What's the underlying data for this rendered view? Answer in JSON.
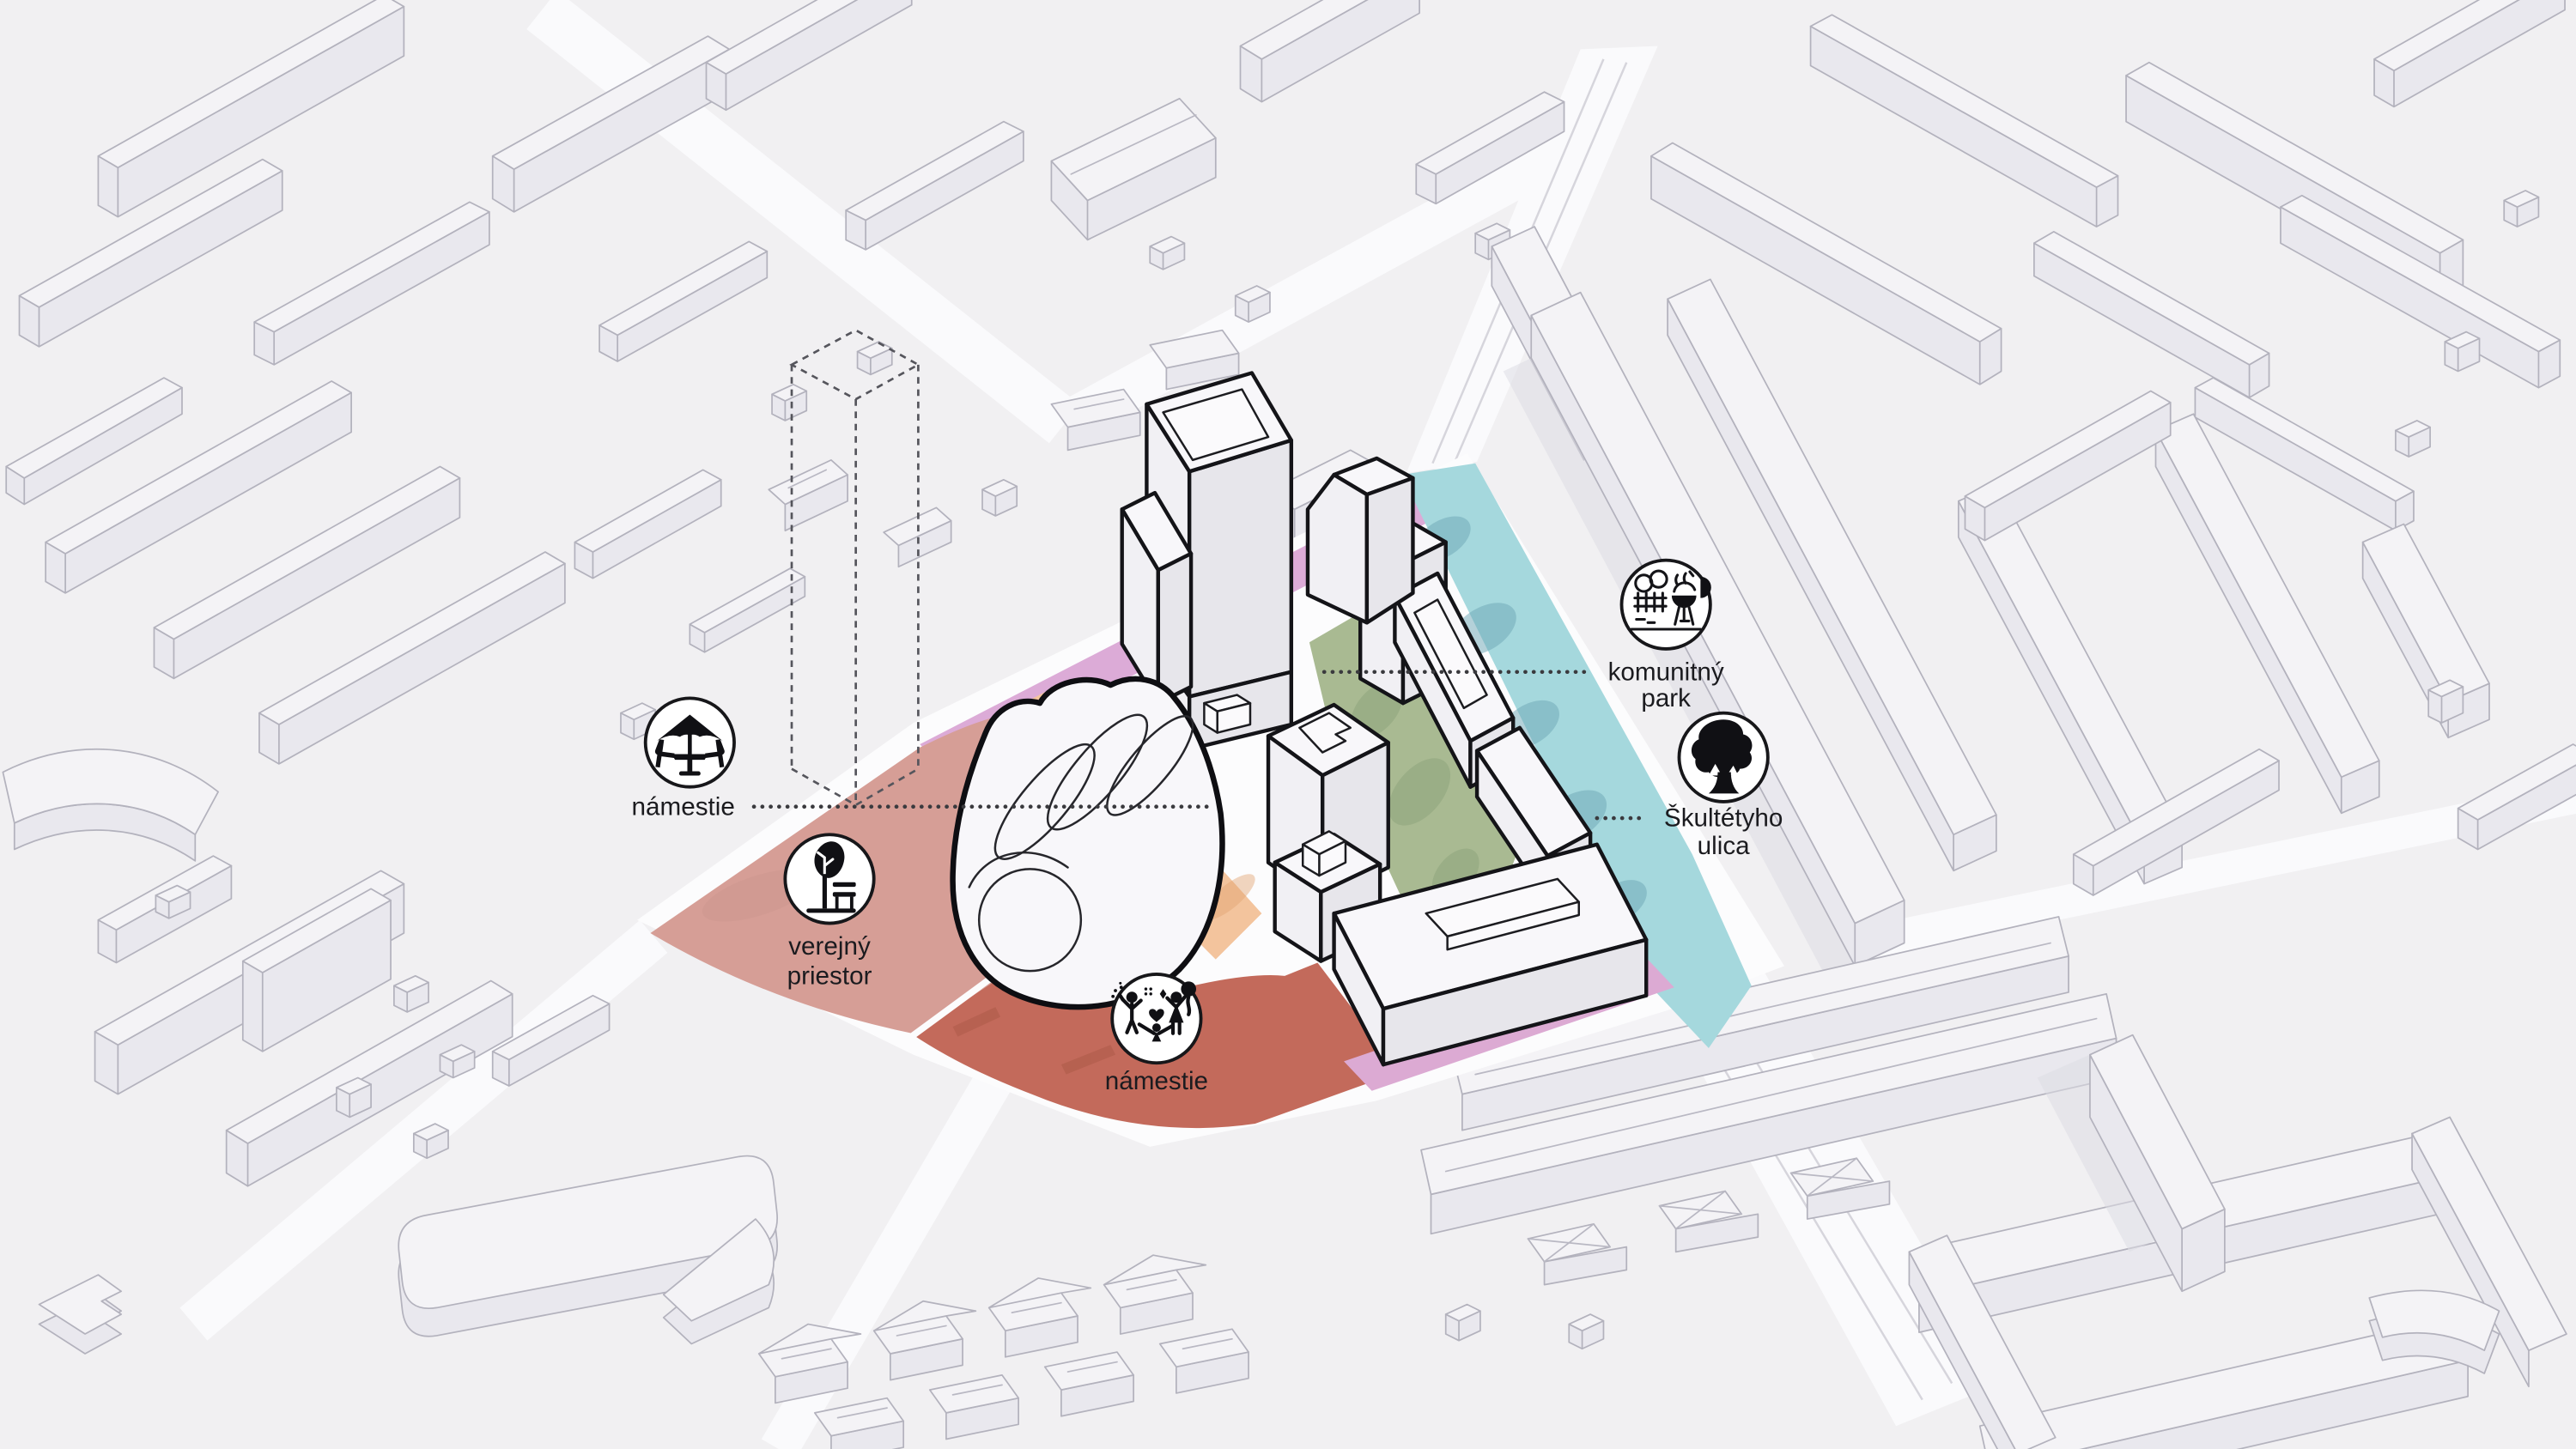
{
  "diagram": {
    "kind": "axonometric urban site plan",
    "annotations": [
      {
        "id": "namestie-west",
        "icon": "parasol-table-icon",
        "label": "námestie"
      },
      {
        "id": "verejny-priestor",
        "icon": "tree-bench-icon",
        "line1": "verejný",
        "line2": "priestor"
      },
      {
        "id": "namestie-south",
        "icon": "celebration-icon",
        "label": "námestie"
      },
      {
        "id": "komunitny-park",
        "icon": "garden-grill-icon",
        "line1": "komunitný",
        "line2": "park"
      },
      {
        "id": "skultetyho-ulica",
        "icon": "street-tree-icon",
        "line1": "Škultétyho",
        "line2": "ulica"
      }
    ],
    "zones": [
      {
        "name": "square-west",
        "color": "#d69e96"
      },
      {
        "name": "square-south",
        "color": "#c36a5b"
      },
      {
        "name": "promenade-northwest",
        "color": "#dcabd7"
      },
      {
        "name": "promenade-south",
        "color": "#dcaad3"
      },
      {
        "name": "paving-orange",
        "color": "#f3c49d"
      },
      {
        "name": "community-park",
        "color": "#a9ba92"
      },
      {
        "name": "skultetyho-street",
        "color": "#a5d8dd"
      }
    ],
    "palette": {
      "ground": "#f1f0f2",
      "street": "#fafafc",
      "halo": "#fcfcfd",
      "cyan_shadow": "#6fa8b6",
      "green_shadow": "#8da37c",
      "red_mark": "#a85744",
      "orange_mark": "#e2a573",
      "rose_mark": "#c08a82"
    }
  }
}
